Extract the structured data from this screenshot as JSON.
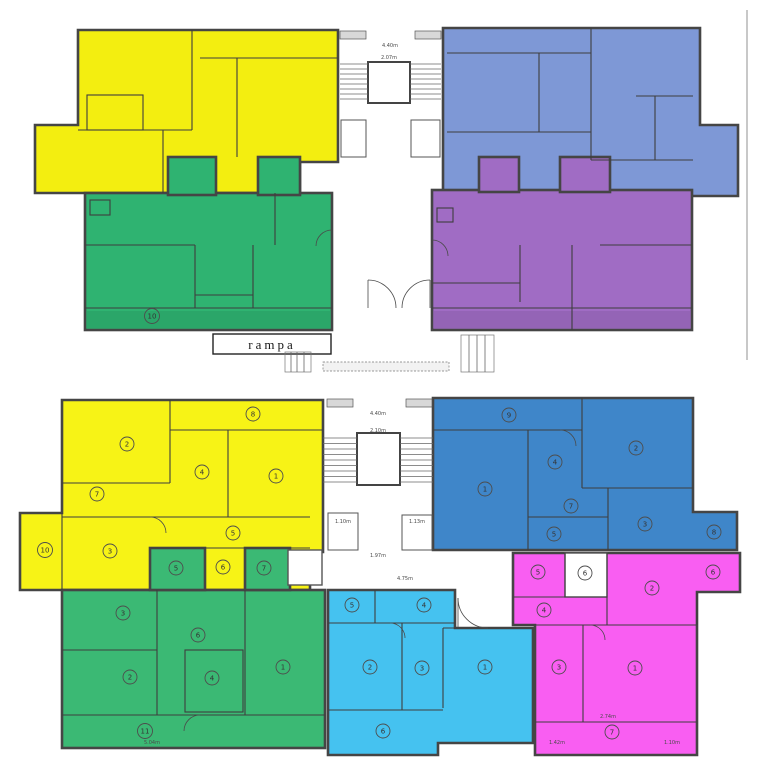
{
  "colors": {
    "top_yellow": "#f3ee10",
    "top_blue": "#7e98d6",
    "top_green": "#2fb371",
    "top_purple": "#a06cc4",
    "bot_yellow": "#f7f316",
    "bot_blue": "#3f86c9",
    "bot_green": "#3bb974",
    "bot_cyan": "#45c2f0",
    "bot_magenta": "#f95ef2"
  },
  "top_plan": {
    "rampa_label": "rampa",
    "dims": {
      "stair_width": "4.40m",
      "stair_well": "2.07m"
    },
    "rooms": {
      "green": [
        "10"
      ]
    }
  },
  "bottom_plan": {
    "dims": {
      "stair_width": "4.40m",
      "stair_well": "2.10m",
      "closet_left": "1.10m",
      "closet_right": "1.13m",
      "landing": "1.97m",
      "hall": "4.75m",
      "green_bottom": "5.04m",
      "magenta_left": "1.42m",
      "magenta_mid": "2.74m",
      "magenta_right": "1.10m"
    },
    "rooms": {
      "yellow": [
        "8",
        "2",
        "4",
        "1",
        "7",
        "5",
        "3",
        "10",
        "6"
      ],
      "yellow_green_annex": [
        "5",
        "7"
      ],
      "blue": [
        "9",
        "2",
        "4",
        "1",
        "7",
        "3",
        "5",
        "8"
      ],
      "green": [
        "3",
        "6",
        "2",
        "4",
        "1",
        "11"
      ],
      "cyan": [
        "5",
        "4",
        "2",
        "3",
        "1",
        "6"
      ],
      "magenta": [
        "5",
        "6",
        "2",
        "6",
        "4",
        "3",
        "1",
        "7"
      ]
    }
  }
}
